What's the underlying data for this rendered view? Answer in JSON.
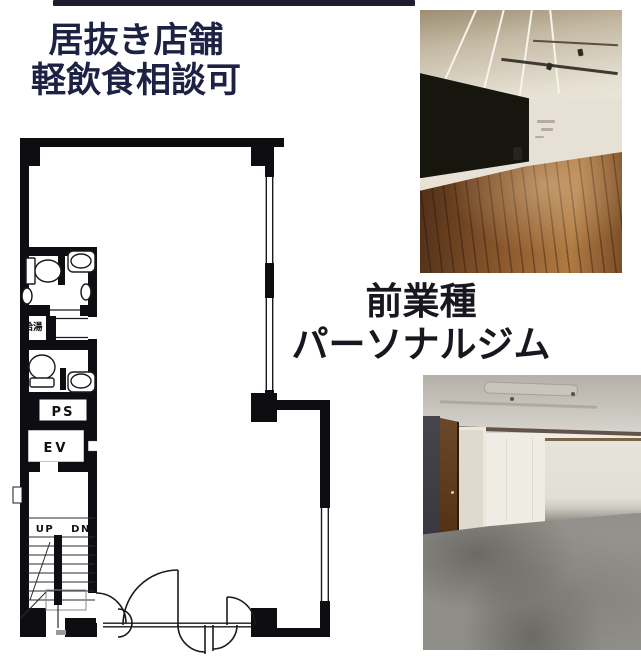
{
  "headline": {
    "line1": "居抜き店舗",
    "line2": "軽飲食相談可",
    "color": "#1d2144"
  },
  "caption": {
    "line1": "前業種",
    "line2": "パーソナルジム",
    "color": "#17171f"
  },
  "floor_plan": {
    "labels": {
      "hot_water": "給湯",
      "pipe_space": "PS",
      "elevator": "EV",
      "stairs_up": "UP",
      "stairs_down": "DN"
    },
    "wall_color": "#0e0e12",
    "line_color": "#1a1a1a"
  },
  "photos": {
    "top_name": "interior-wood-floor-room",
    "bottom_name": "interior-gym-room"
  },
  "artifacts": {
    "top_strip_color": "#1d1d30"
  }
}
